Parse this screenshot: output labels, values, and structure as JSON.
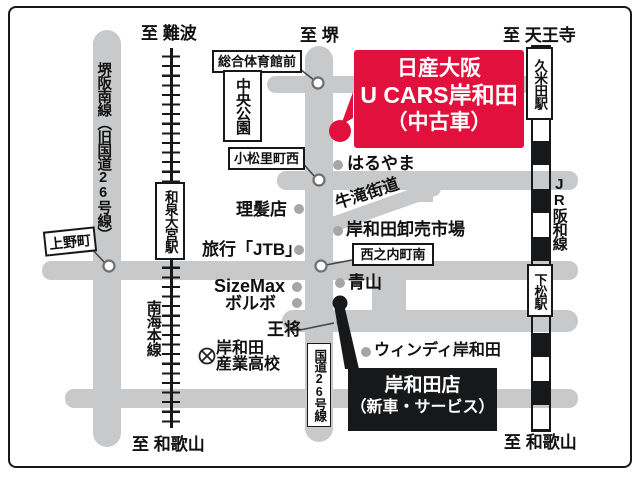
{
  "directions": {
    "namba": "至 難波",
    "sakai": "至 堺",
    "tennoji": "至 天王寺",
    "wakayama_sw": "至 和歌山",
    "wakayama_se": "至 和歌山"
  },
  "dealer_used": {
    "line1": "日産大阪",
    "line2": "U CARS岸和田",
    "line3": "（中古車）"
  },
  "dealer_new": {
    "line1": "岸和田店",
    "line2": "（新車・サービス）"
  },
  "roads": {
    "sakai_hannan_line": "堺阪南線（旧国道26号線）",
    "route26_label": "国道26号線",
    "ushitaki_kaido": "牛滝街道"
  },
  "railways": {
    "nankai_main_line": "南海本線",
    "izumi_omiya_station": "和泉大宮駅",
    "jr_hanwa_line": "JR阪和線",
    "kumeda_station": "久米田駅",
    "shimomatsu_station": "下松駅"
  },
  "intersections": {
    "sogo_taiikukan_mae": "総合体育館前",
    "komatsuri_cho_nishi": "小松里町西",
    "ueno_cho": "上野町",
    "nishinouchi_cho_minami": "西之内町南"
  },
  "places": {
    "chuo_koen": "中央公園",
    "haruyama": "はるやま",
    "rihatsuten": "理髪店",
    "oroshiuri_ichiba": "岸和田卸売市場",
    "jtb": "旅行「JTB」",
    "sizemax": "SizeMax",
    "volvo": "ボルボ",
    "aoyama": "青山",
    "ohsho": "王将",
    "windy_kishiwada": "ウィンディ岸和田",
    "school_line1": "岸和田",
    "school_line2": "産業高校"
  },
  "colors": {
    "road_gray": "#c8c9ca",
    "accent_red": "#e2103c",
    "box_black": "#16181a",
    "dot_gray": "#a5a6a7"
  }
}
